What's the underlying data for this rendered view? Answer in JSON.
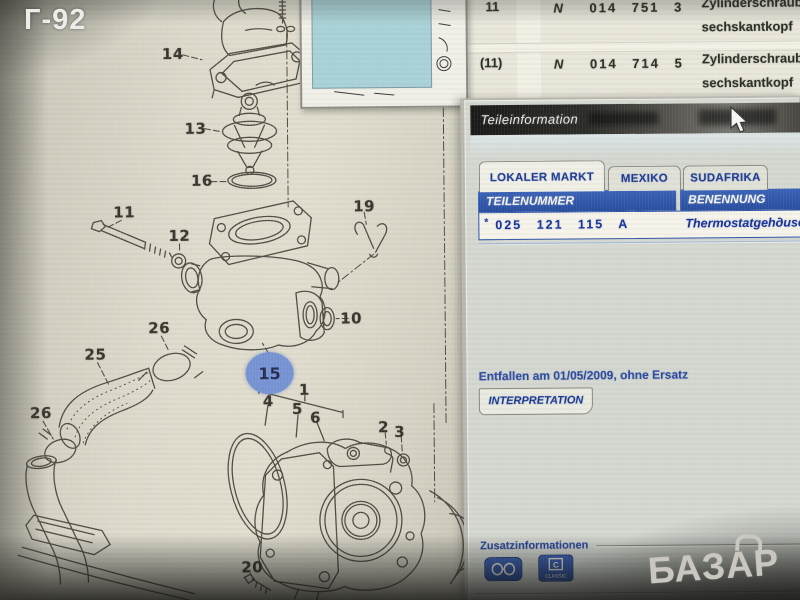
{
  "photo": {
    "camera_label": "Г-92",
    "marketplace_logo": "БАЗАР"
  },
  "background_list": {
    "rows": [
      {
        "pos": "11",
        "std": "N",
        "part_number": "014 751 3",
        "desc1": "Zylinderschraub",
        "desc2": "sechskantkopf"
      },
      {
        "pos": "(11)",
        "std": "N",
        "part_number": "014 714 5",
        "desc1": "Zylinderschraub",
        "desc2": "sechskantkopf"
      }
    ]
  },
  "diagram": {
    "callouts": [
      "14",
      "13",
      "16",
      "11",
      "12",
      "19",
      "10",
      "26",
      "25",
      "26",
      "15",
      "1",
      "4",
      "5",
      "6",
      "2",
      "3",
      "20"
    ],
    "highlighted": "15",
    "highlight_color": "#7693d3"
  },
  "window": {
    "title": "Teileinformation",
    "tabs": [
      {
        "label": "LOKALER MARKT",
        "active": true
      },
      {
        "label": "MEXIKO",
        "active": false
      },
      {
        "label": "SUDAFRIKA",
        "active": false
      }
    ],
    "table": {
      "col1": "TEILENUMMER",
      "col2": "BENENNUNG",
      "row": {
        "marker": "*",
        "part_number": "025 121 115 A",
        "name": "Thermostatgehдuse"
      }
    },
    "note": "Entfallen am 01/05/2009, ohne Ersatz",
    "interpretation": "INTERPRETATION",
    "zusatz_label": "Zusatzinformationen",
    "icons": [
      {
        "name": "glasses-icon",
        "label": ""
      },
      {
        "name": "classic-icon",
        "label": "CLASSIC"
      }
    ],
    "accent_blue": "#2b51a8",
    "text_blue": "#16329c"
  }
}
